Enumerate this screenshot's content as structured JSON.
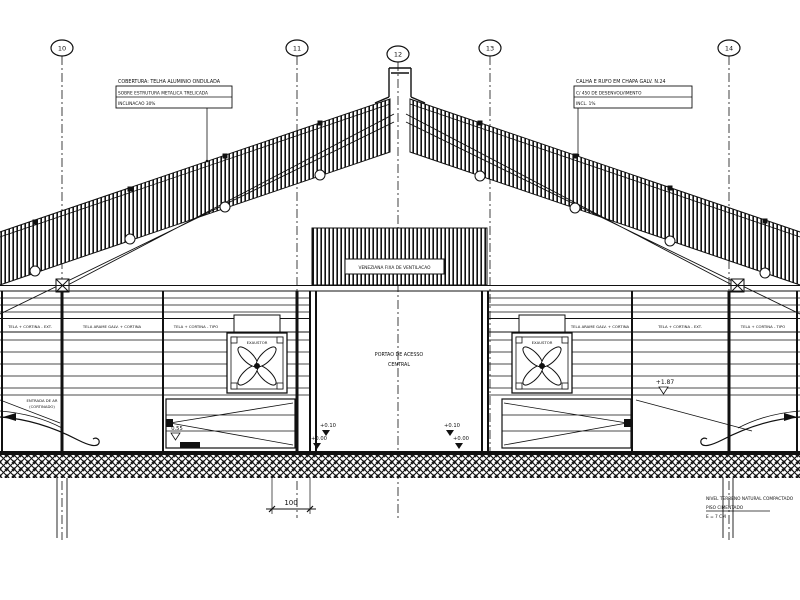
{
  "title": "Building cross-section technical drawing",
  "colors": {
    "line": "#111111",
    "background": "#ffffff"
  },
  "drawing": {
    "grid_bubbles": [
      {
        "label": "10"
      },
      {
        "label": "11"
      },
      {
        "label": "12"
      },
      {
        "label": "13"
      },
      {
        "label": "14"
      }
    ],
    "note_top_left": {
      "line1": "COBERTURA: TELHA ALUMINIO ONDULADA",
      "line2": "SOBRE ESTRUTURA METALICA TRELICADA",
      "line3": "INCLINACAO 30%"
    },
    "note_top_right": {
      "line1": "CALHA E RUFO EM CHAPA GALV. N.24",
      "line2": "C/ 450 DE DESENVOLVIMENTO",
      "line3": "INCL. 1%"
    },
    "roof_label": "VENEZIANA FIXA DE VENTILACAO",
    "door_label": {
      "line1": "PORTAO DE ACESSO",
      "line2": "CENTRAL"
    },
    "band_texts": [
      "TELA + CORTINA - EXT.",
      "TELA ARAME GALV. + CORTINA",
      "TELA + CORTINA - TIPO",
      "TELA ARAME GALV. + CORTINA",
      "TELA + CORTINA - EXT.",
      "TELA + CORTINA - TIPO"
    ],
    "fan_label": "EXAUSTOR",
    "ramp_label": {
      "line1": "ENTRADA DE AR",
      "line2": "(CORTINADO)"
    },
    "levels": {
      "left": "0.55",
      "center_upper": "+0.10",
      "center_lower": "+0.00",
      "right_upper": "+0.10",
      "right_lower": "+0.00",
      "eave_right": "+1.87"
    },
    "dimension_bottom": "100",
    "note_bottom_right": {
      "line1": "NIVEL TERRENO NATURAL COMPACTADO",
      "line2": "PISO CIMENTADO",
      "line3": "E = 7 CM"
    }
  }
}
